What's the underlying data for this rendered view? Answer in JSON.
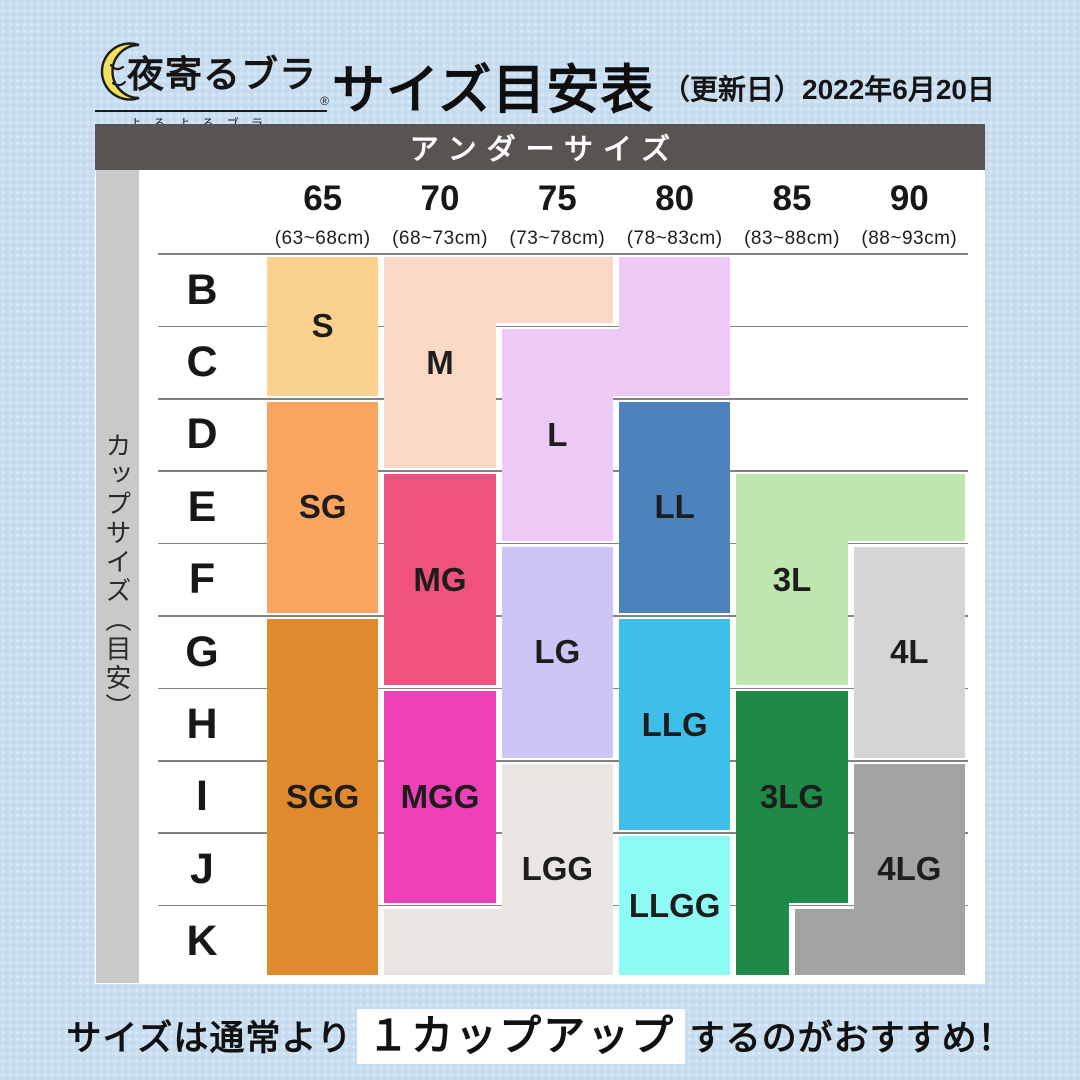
{
  "logo": {
    "brand": "夜寄るブラ",
    "star": "★",
    "reg": "®",
    "furigana": "よるよるブラ",
    "moon_color": "#F2E15C"
  },
  "header": {
    "title": "サイズ目安表",
    "date_note": "（更新日）2022年6月20日"
  },
  "table": {
    "corner_header": "アンダーサイズ",
    "side_header": "カップサイズ（目安）"
  },
  "footer": {
    "pre": "サイズは通常より",
    "em": "１カップアップ",
    "post": "するのがおすすめ！"
  },
  "chart_data": {
    "type": "heatmap",
    "title": "サイズ目安表",
    "x_label": "アンダーサイズ",
    "y_label": "カップサイズ（目安）",
    "x_categories": [
      "65",
      "70",
      "75",
      "80",
      "85",
      "90"
    ],
    "x_ranges": [
      "(63~68cm)",
      "(68~73cm)",
      "(73~78cm)",
      "(78~83cm)",
      "(83~88cm)",
      "(88~93cm)"
    ],
    "y_categories": [
      "B",
      "C",
      "D",
      "E",
      "F",
      "G",
      "H",
      "I",
      "J",
      "K"
    ],
    "legend_note": "cells give recommended product size for underbust × cup combination",
    "layout": {
      "c0": 169,
      "cw": 117.333,
      "r0": 130,
      "rh": 72.4,
      "inset": 3,
      "line_x0": 63,
      "line_x1": 873,
      "line_color": "#828282"
    },
    "blocks": [
      {
        "label": "S",
        "color": "#FBD28D",
        "cells": "65:B-C",
        "rects": [
          [
            0,
            0,
            1,
            2,
            [
              1,
              1,
              1,
              1
            ]
          ]
        ],
        "label_at": [
          0,
          0,
          2
        ]
      },
      {
        "label": "M",
        "color": "#FAD8C6",
        "cells": "70:B-D, 75:B",
        "rects": [
          [
            1,
            0,
            1,
            3,
            [
              1,
              1,
              1,
              1
            ]
          ],
          [
            2,
            0,
            1,
            1,
            [
              1,
              1,
              1,
              -2
            ]
          ]
        ],
        "label_at": [
          1,
          0,
          3
        ]
      },
      {
        "label": "L",
        "color": "#EDC9F5",
        "cells": "80:B-C, 75:C-E",
        "rects": [
          [
            2,
            1,
            1,
            3,
            [
              1,
              1,
              1,
              1
            ]
          ],
          [
            3,
            0,
            1,
            2,
            [
              1,
              1,
              1,
              1
            ]
          ],
          [
            2,
            1,
            2,
            1,
            [
              1,
              1,
              1,
              1
            ]
          ]
        ],
        "label_at": [
          2,
          1,
          3
        ]
      },
      {
        "label": "SG",
        "color": "#F9A45F",
        "cells": "65:D-F",
        "rects": [
          [
            0,
            2,
            1,
            3,
            [
              1,
              1,
              1,
              1
            ]
          ]
        ],
        "label_at": [
          0,
          2,
          3
        ]
      },
      {
        "label": "MG",
        "color": "#F0517F",
        "cells": "70:E-G",
        "rects": [
          [
            1,
            3,
            1,
            3,
            [
              1,
              1,
              1,
              1
            ]
          ]
        ],
        "label_at": [
          1,
          3,
          3
        ]
      },
      {
        "label": "LG",
        "color": "#CDC5F3",
        "cells": "75:F-H",
        "rects": [
          [
            2,
            4,
            1,
            3,
            [
              1,
              1,
              1,
              1
            ]
          ]
        ],
        "label_at": [
          2,
          4,
          3
        ]
      },
      {
        "label": "LL",
        "color": "#4C83BC",
        "cells": "80:D-F",
        "rects": [
          [
            3,
            2,
            1,
            3,
            [
              1,
              1,
              1,
              1
            ]
          ]
        ],
        "label_at": [
          3,
          2,
          3
        ]
      },
      {
        "label": "3L",
        "color": "#C0E6AF",
        "cells": "85:E-G, 90:E",
        "rects": [
          [
            4,
            3,
            1,
            3,
            [
              1,
              1,
              1,
              1
            ]
          ],
          [
            5,
            3,
            1,
            1,
            [
              1,
              1,
              1,
              -2
            ]
          ]
        ],
        "label_at": [
          4,
          3,
          3
        ]
      },
      {
        "label": "4L",
        "color": "#D5D5D5",
        "cells": "90:F-H",
        "rects": [
          [
            5,
            4,
            1,
            3,
            [
              1,
              1,
              1,
              1
            ]
          ]
        ],
        "label_at": [
          5,
          4,
          3
        ]
      },
      {
        "label": "SGG",
        "color": "#E18A2D",
        "cells": "65:G-K",
        "rects": [
          [
            0,
            5,
            1,
            5,
            [
              1,
              1,
              1,
              1
            ]
          ]
        ],
        "label_at": [
          0,
          5,
          5
        ]
      },
      {
        "label": "MGG",
        "color": "#EE40B8",
        "cells": "70:H-J",
        "rects": [
          [
            1,
            6,
            1,
            3,
            [
              1,
              1,
              1,
              1
            ]
          ]
        ],
        "label_at": [
          1,
          6,
          3
        ]
      },
      {
        "label": "LGG",
        "color": "#E9E6E1",
        "cells": "75:I-K, 70:K",
        "rects": [
          [
            2,
            7,
            1,
            3,
            [
              1,
              1,
              1,
              1
            ]
          ],
          [
            1,
            9,
            1,
            1,
            [
              1,
              -2,
              1,
              1
            ]
          ]
        ],
        "label_at": [
          2,
          7,
          3
        ]
      },
      {
        "label": "LLG",
        "color": "#3EBFE9",
        "cells": "80:G-I",
        "rects": [
          [
            3,
            5,
            1,
            3,
            [
              1,
              1,
              1,
              1
            ]
          ]
        ],
        "label_at": [
          3,
          5,
          3
        ]
      },
      {
        "label": "LLGG",
        "color": "#8DFAF4",
        "cells": "80:J-K",
        "rects": [
          [
            3,
            8,
            1,
            2,
            [
              1,
              1,
              1,
              1
            ]
          ]
        ],
        "label_at": [
          3,
          8,
          2
        ]
      },
      {
        "label": "3LG",
        "color": "#1F8A47",
        "cells": "85:H-J, 85(left half):K",
        "rects": [
          [
            4,
            6,
            1,
            3,
            [
              1,
              1,
              1,
              1
            ]
          ],
          [
            4,
            9,
            0.5,
            1,
            [
              -2,
              1,
              1,
              1
            ]
          ]
        ],
        "label_at": [
          4,
          6,
          3
        ]
      },
      {
        "label": "4LG",
        "color": "#A3A3A3",
        "cells": "90:I-K, 85(right half):K",
        "rects": [
          [
            5,
            7,
            1,
            3,
            [
              1,
              1,
              1,
              1
            ]
          ],
          [
            4.5,
            9,
            0.5,
            1,
            [
              1,
              -2,
              1,
              1
            ]
          ]
        ],
        "label_at": [
          5,
          7,
          3
        ]
      }
    ]
  }
}
